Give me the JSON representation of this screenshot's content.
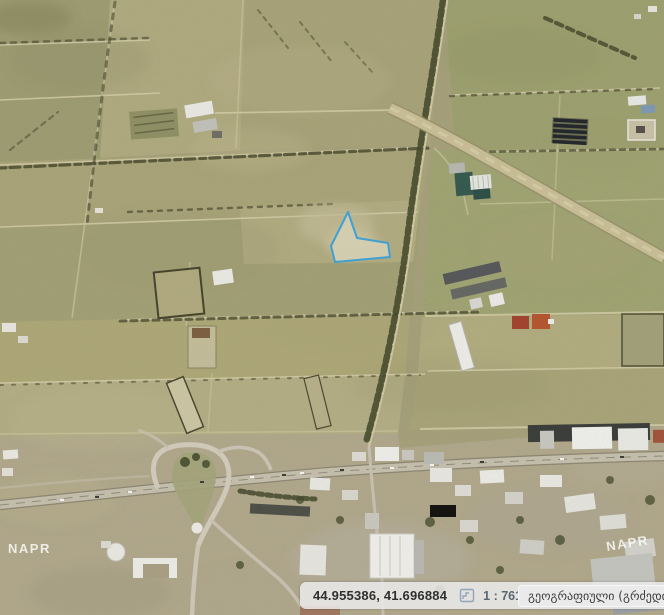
{
  "map": {
    "watermark": "NAPR",
    "selected_parcel": {
      "outline_color": "#3fa3d8",
      "fill_color": "#d8d2b5"
    }
  },
  "status_bar": {
    "coordinates": "44.955386, 41.696884",
    "scale": "1 : 7611",
    "crs_label": "გეოგრაფიული (გრძედი,განედი)",
    "icon_color": "#93a5ba",
    "panel_bg": "#e9e9e9"
  }
}
